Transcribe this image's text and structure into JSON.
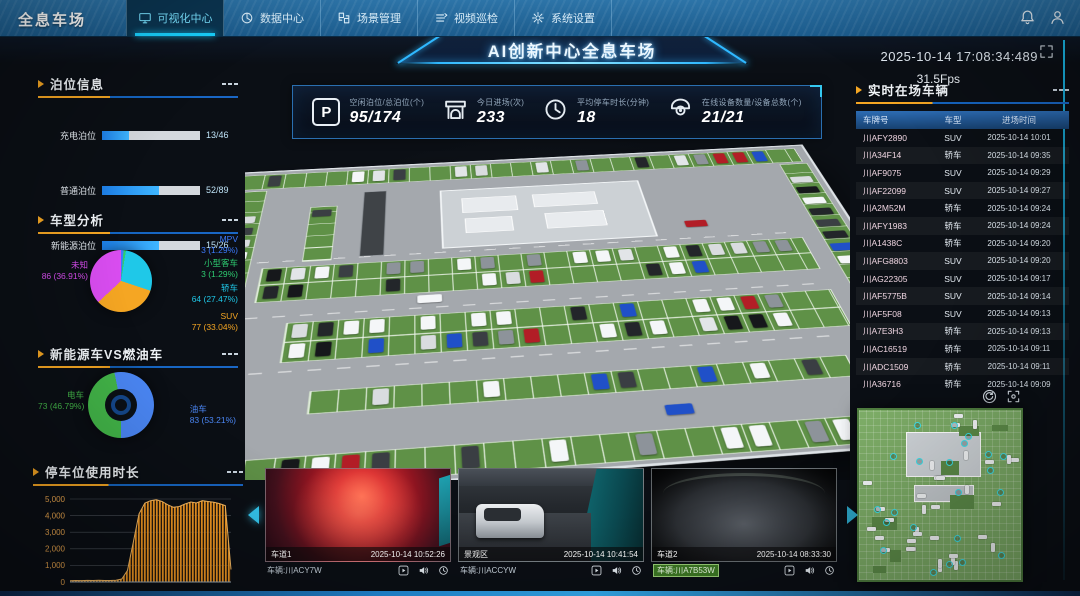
{
  "nav": {
    "logo": "全息车场",
    "tabs": [
      {
        "id": "visualization-center",
        "label": "可视化中心",
        "icon": "monitor-icon",
        "active": true
      },
      {
        "id": "data-center",
        "label": "数据中心",
        "icon": "data-icon",
        "active": false
      },
      {
        "id": "scene-management",
        "label": "场景管理",
        "icon": "scene-icon",
        "active": false
      },
      {
        "id": "video-patrol",
        "label": "视频巡检",
        "icon": "patrol-icon",
        "active": false
      },
      {
        "id": "system-settings",
        "label": "系统设置",
        "icon": "gear-icon",
        "active": false
      }
    ],
    "right_icons": [
      "bell-icon",
      "user-icon"
    ]
  },
  "header": {
    "title": "AI创新中心全息车场",
    "datetime": "2025-10-14 17:08:34:489",
    "fps": "31.5Fps"
  },
  "stats": {
    "items": [
      {
        "icon": "parking-icon",
        "label": "空闲泊位/总泊位(个)",
        "value": "95/174"
      },
      {
        "icon": "gate-icon",
        "label": "今日进场(次)",
        "value": "233"
      },
      {
        "icon": "clock-icon",
        "label": "平均停车时长(分钟)",
        "value": "18"
      },
      {
        "icon": "camera-icon",
        "label": "在线设备数量/设备总数(个)",
        "value": "21/21"
      }
    ]
  },
  "berth_info": {
    "title": "泊位信息",
    "rows": [
      {
        "label": "充电泊位",
        "free": 13,
        "total": 46,
        "value": "13/46"
      },
      {
        "label": "普通泊位",
        "free": 52,
        "total": 89,
        "value": "52/89"
      },
      {
        "label": "新能源泊位",
        "free": 15,
        "total": 26,
        "value": "15/26"
      }
    ]
  },
  "live_vehicles": {
    "title": "实时在场车辆",
    "columns": [
      "车牌号",
      "车型",
      "进场时间"
    ],
    "rows": [
      [
        "川AFY2890",
        "SUV",
        "2025-10-14 10:01"
      ],
      [
        "川A34F14",
        "轿车",
        "2025-10-14 09:35"
      ],
      [
        "川AF9075",
        "SUV",
        "2025-10-14 09:29"
      ],
      [
        "川AF22099",
        "SUV",
        "2025-10-14 09:27"
      ],
      [
        "川A2M52M",
        "轿车",
        "2025-10-14 09:24"
      ],
      [
        "川AFY1983",
        "轿车",
        "2025-10-14 09:24"
      ],
      [
        "川A1438C",
        "轿车",
        "2025-10-14 09:20"
      ],
      [
        "川AFG8803",
        "SUV",
        "2025-10-14 09:20"
      ],
      [
        "川AG22305",
        "SUV",
        "2025-10-14 09:17"
      ],
      [
        "川AF5775B",
        "SUV",
        "2025-10-14 09:14"
      ],
      [
        "川AF5F08",
        "SUV",
        "2025-10-14 09:13"
      ],
      [
        "川A7E3H3",
        "轿车",
        "2025-10-14 09:13"
      ],
      [
        "川AC16519",
        "轿车",
        "2025-10-14 09:11"
      ],
      [
        "川ADC1509",
        "轿车",
        "2025-10-14 09:11"
      ],
      [
        "川A36716",
        "轿车",
        "2025-10-14 09:09"
      ]
    ]
  },
  "cameras": {
    "items": [
      {
        "name": "车道1",
        "timestamp": "2025-10-14 10:52:26",
        "vehicle": "车辆:川ACY7W",
        "scene": "red",
        "selected": false
      },
      {
        "name": "景观区",
        "timestamp": "2025-10-14 10:41:54",
        "vehicle": "车辆:川ACCYW",
        "scene": "lane",
        "selected": false
      },
      {
        "name": "车道2",
        "timestamp": "2025-10-14 08:33:30",
        "vehicle": "车辆:川A7B53W",
        "scene": "fisheye",
        "selected": true
      }
    ],
    "toolbar_icons": [
      "play-icon",
      "speaker-icon",
      "history-icon"
    ]
  },
  "minimap_tools": [
    "refresh-icon",
    "focus-icon"
  ],
  "chart_data": [
    {
      "id": "vehicle_type",
      "type": "pie",
      "title": "车型分析",
      "slices": [
        {
          "name": "MPV",
          "value": 3,
          "pct": "1.29%",
          "color": "#3d7bfd"
        },
        {
          "name": "小型客车",
          "value": 3,
          "pct": "1.29%",
          "color": "#2ecc71"
        },
        {
          "name": "轿车",
          "value": 64,
          "pct": "27.47%",
          "color": "#1fc8e8"
        },
        {
          "name": "SUV",
          "value": 77,
          "pct": "33.04%",
          "color": "#f5a623"
        },
        {
          "name": "未知",
          "value": 86,
          "pct": "36.91%",
          "color": "#d94df0"
        }
      ]
    },
    {
      "id": "energy_vs_fuel",
      "type": "donut",
      "title": "新能源车VS燃油车",
      "slices": [
        {
          "name": "电车",
          "value": 73,
          "pct": "46.79%",
          "color": "#43b649"
        },
        {
          "name": "油车",
          "value": 83,
          "pct": "53.21%",
          "color": "#4b87f5"
        }
      ]
    },
    {
      "id": "usage_duration",
      "type": "area",
      "title": "停车位使用时长",
      "yticks": [
        "5,000",
        "4,000",
        "3,000",
        "2,000",
        "1,000",
        "0"
      ],
      "ylim": [
        0,
        5000
      ],
      "color": "#f59a23",
      "values": [
        80,
        90,
        85,
        95,
        88,
        100,
        92,
        90,
        105,
        180,
        700,
        2400,
        4100,
        4750,
        4900,
        4950,
        4850,
        4650,
        4500,
        4550,
        4700,
        4820,
        4760,
        4900,
        4850,
        4800,
        4720,
        4600,
        750
      ]
    }
  ]
}
